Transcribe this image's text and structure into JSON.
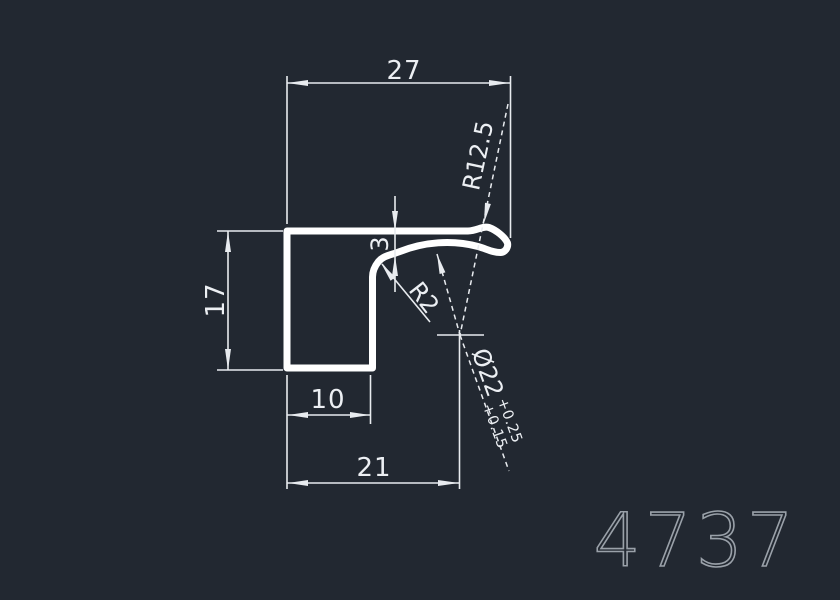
{
  "drawing": {
    "type": "cad-profile-cross-section",
    "part_number": "4737",
    "colors": {
      "background": "#222831",
      "geometry_line": "#ffffff",
      "dimension_line": "#e8ebef",
      "dimension_text": "#eceff3",
      "part_number_text": "#9aa1a9"
    },
    "dimensions": {
      "top_width": "27",
      "left_height": "17",
      "leg_width": "10",
      "center_offset": "21",
      "flange_thickness": "3",
      "outer_radius": "R12.5",
      "inner_radius": "R2",
      "diameter": "Ø22",
      "tolerance_upper": "+0.25",
      "tolerance_lower": "+0.15"
    }
  }
}
